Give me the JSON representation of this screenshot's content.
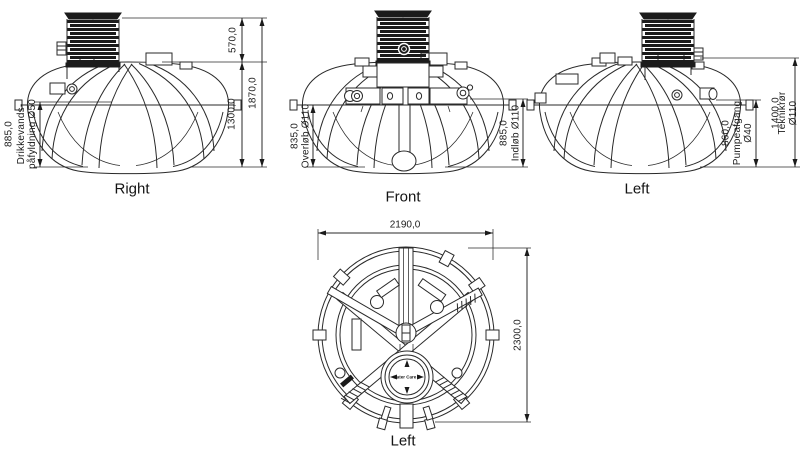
{
  "colors": {
    "line": "#2a2a2a",
    "dark_fill": "#1b1b1b",
    "background": "#ffffff"
  },
  "views": {
    "right": {
      "label": "Right",
      "dims": {
        "fill_port": {
          "value": "885,0",
          "label": "Drikkevands-\npåfyldning Ø50"
        },
        "riser_height": "570,0",
        "body_height": "1300,0",
        "total_height": "1870,0"
      }
    },
    "front": {
      "label": "Front",
      "dims": {
        "overflow": {
          "value": "835,0",
          "label": "Overløb Ø110"
        },
        "inlet": {
          "value": "885,0",
          "label": "Indløb Ø110"
        }
      }
    },
    "left": {
      "label": "Left",
      "dims": {
        "pump_outlet": {
          "value": "860,0",
          "label": "Pumpeafgang\nØ40"
        },
        "tech_pipe": {
          "value": "1400,0",
          "label": "Teknikrør Ø110"
        }
      }
    },
    "plan": {
      "label": "Left",
      "dims": {
        "width": "2190,0",
        "height": "2300,0"
      },
      "manhole_logo": "water Care ®"
    }
  }
}
